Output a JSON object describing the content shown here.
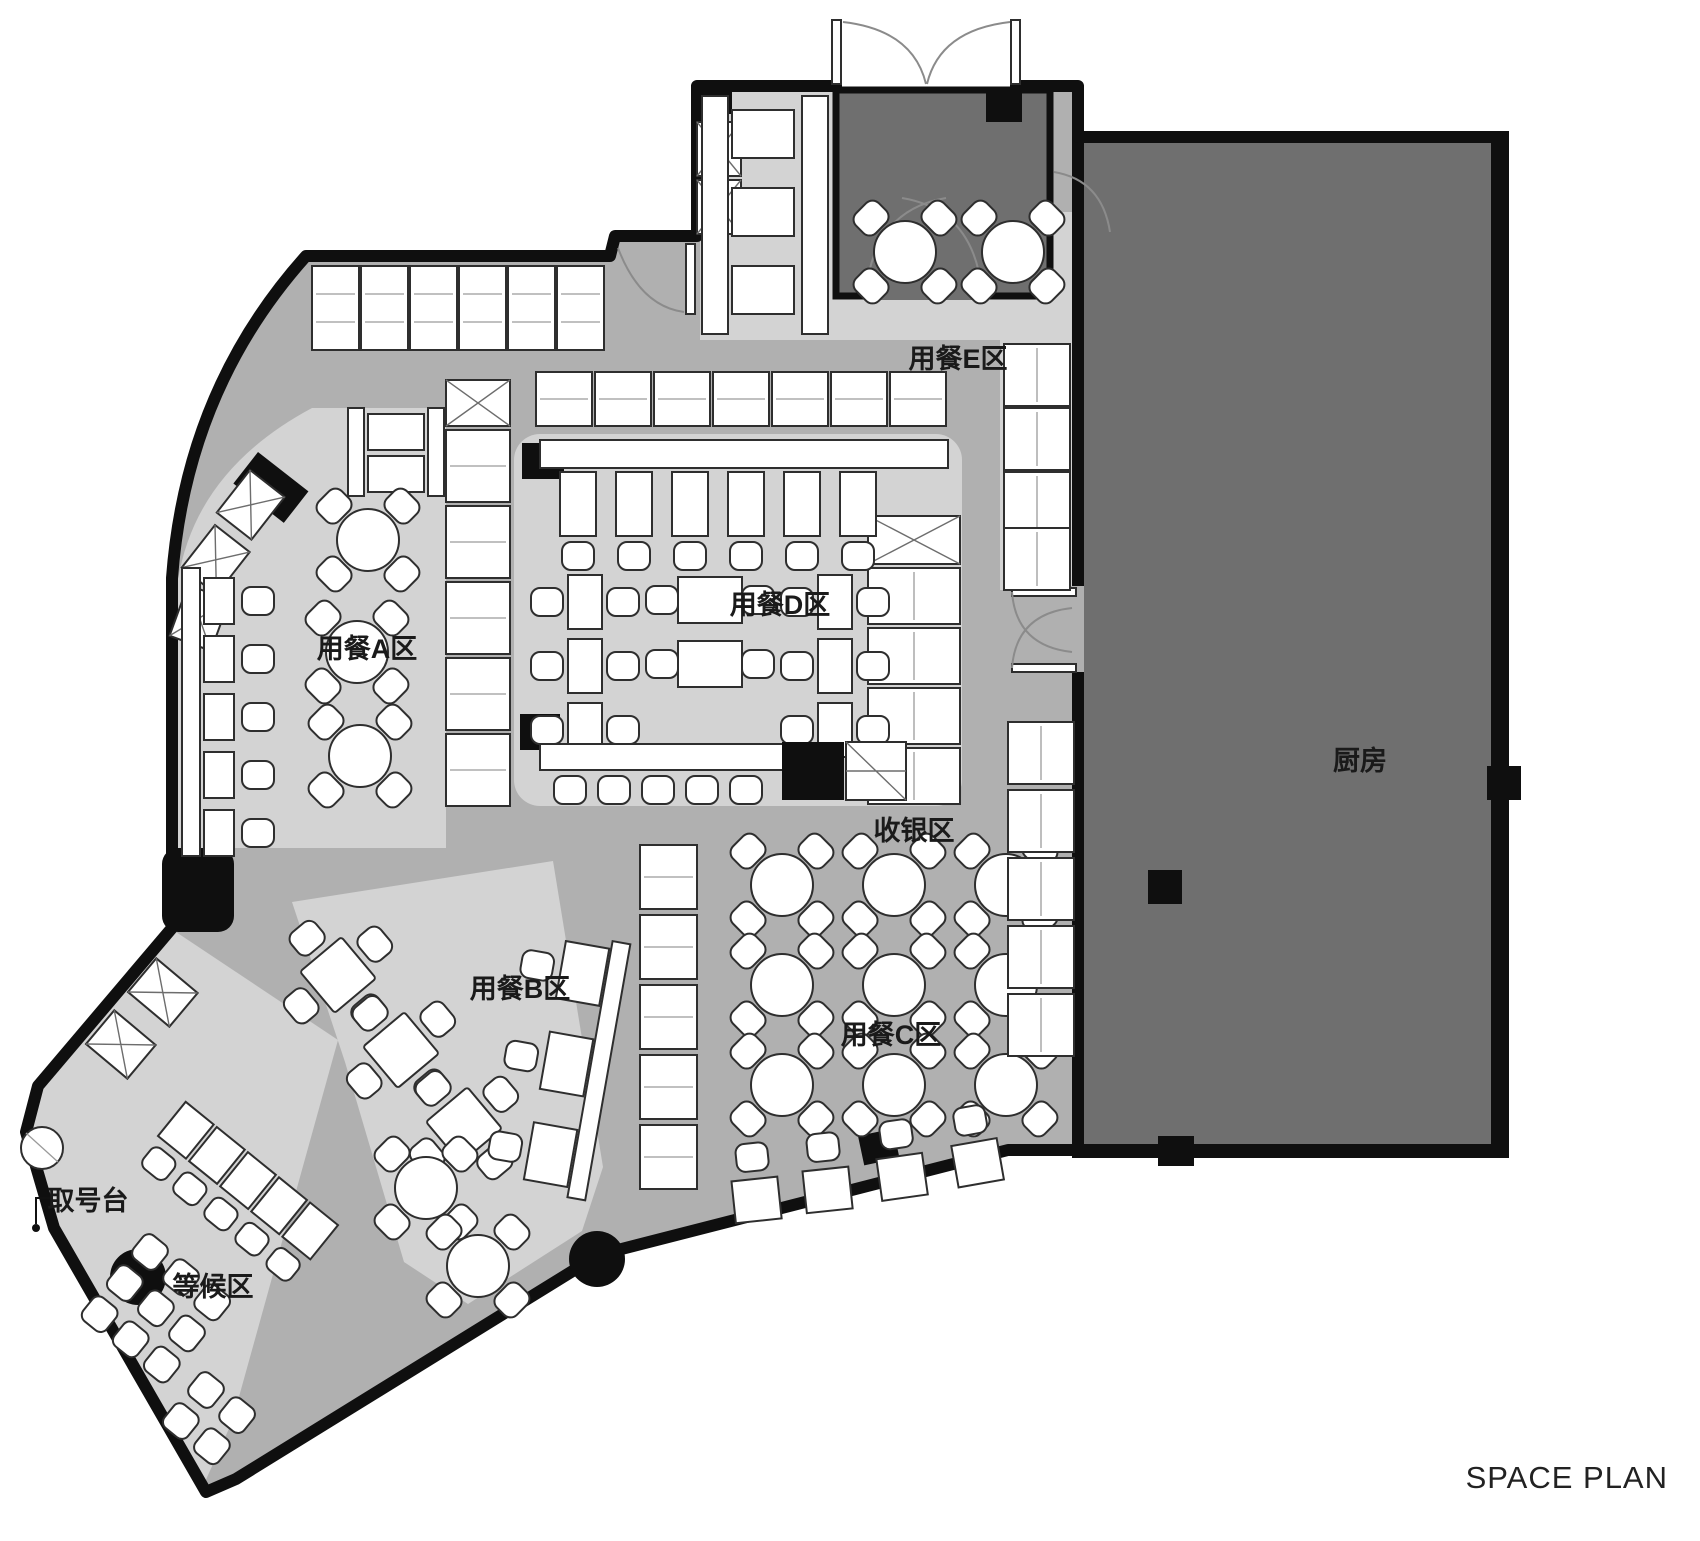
{
  "plan": {
    "title": "SPACE PLAN",
    "zones": {
      "dining_a": "用餐A区",
      "dining_b": "用餐B区",
      "dining_c": "用餐C区",
      "dining_d": "用餐D区",
      "dining_e": "用餐E区",
      "cashier": "收银区",
      "kitchen": "厨房",
      "ticket_counter": "取号台",
      "waiting_area": "等候区"
    },
    "colors": {
      "background": "#ffffff",
      "wall": "#0f0f0f",
      "circulation_fill": "#b0b0b0",
      "zone_fill": "#d3d3d3",
      "kitchen_fill": "#6f6f6f",
      "furniture_fill": "#ffffff"
    }
  }
}
